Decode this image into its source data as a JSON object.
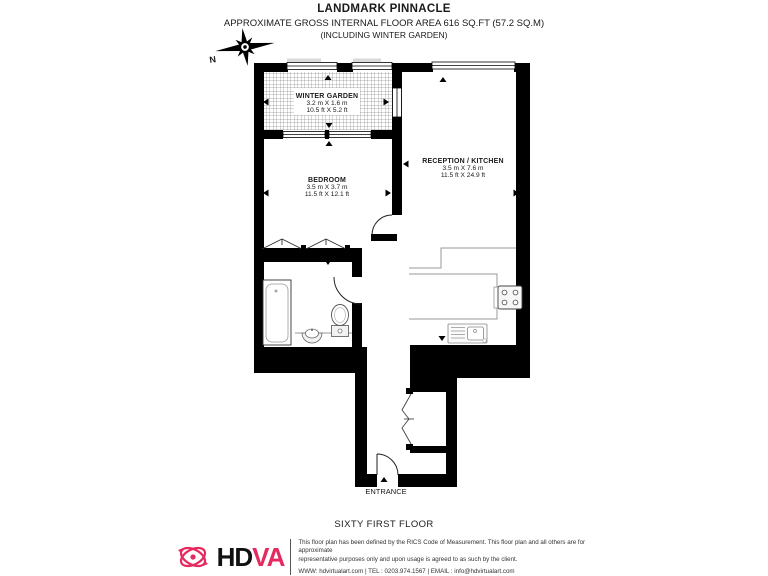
{
  "header": {
    "title": "LANDMARK PINNACLE",
    "subtitle": "APPROXIMATE GROSS INTERNAL FLOOR AREA 616 SQ.FT (57.2 SQ.M)",
    "note": "(INCLUDING WINTER GARDEN)"
  },
  "compass": {
    "label": "N"
  },
  "rooms": {
    "winter_garden": {
      "name": "WINTER GARDEN",
      "metric": "3.2 m X 1.6 m",
      "imperial": "10.5 ft X 5.2 ft"
    },
    "bedroom": {
      "name": "BEDROOM",
      "metric": "3.5 m X 3.7 m",
      "imperial": "11.5 ft X 12.1 ft"
    },
    "reception_kitchen": {
      "name": "RECEPTION / KITCHEN",
      "metric": "3.5 m X 7.6 m",
      "imperial": "11.5 ft X 24.9 ft"
    }
  },
  "labels": {
    "entrance": "ENTRANCE",
    "floor": "SIXTY FIRST FLOOR"
  },
  "footer": {
    "brand_hd": "HD",
    "brand_va": "VA",
    "brand_color": "#e62a5f",
    "disclaimer_line1": "This floor plan has been defined by the RICS Code of Measurement. This floor plan and all others are for approximate",
    "disclaimer_line2": "representative purposes only and upon usage is agreed to as such by the client.",
    "contact": "WWW: hdvirtualart.com | TEL : 0203.974.1567 | EMAIL : info@hdvirtualart.com"
  }
}
